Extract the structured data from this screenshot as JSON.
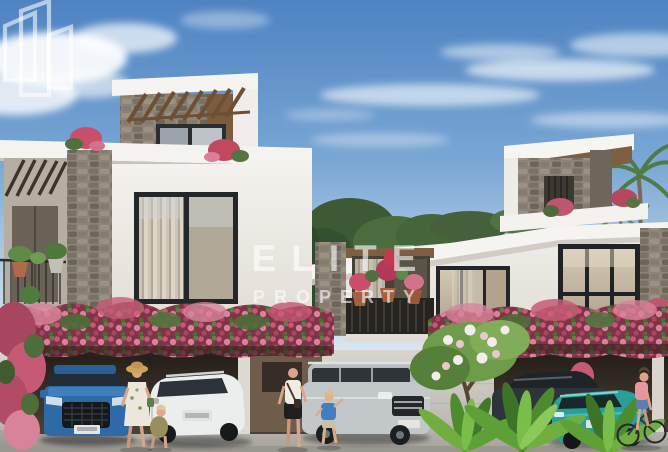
{
  "watermark": {
    "line1": "ELITE",
    "line2": "PROPERTY",
    "logo_icon": "buildings-outline-logo-icon",
    "color": "#FFFFFF",
    "opacity": 0.6
  },
  "scene": {
    "alt": "Rendering of modern two-storey stone and white villas with rooftop pergolas, bougainvillea-covered carports, parked cars, pedestrians and a cyclist on a sunny street",
    "elements": {
      "left_villa": "white villa with stone tower and wood pergola",
      "right_villa": "white villa with rooftop terrace and palm trees",
      "vehicles": [
        "blue suv",
        "white suv",
        "silver suv",
        "dark sedan",
        "teal car"
      ],
      "people": [
        "woman with straw hat",
        "crouching child",
        "woman with shoulder bag",
        "toddler in blue shirt",
        "cyclist in pink top"
      ]
    }
  },
  "palette": {
    "sky_blue": "#4e83c2",
    "sky_horizon": "#d9e4ee",
    "wall_white": "#f2f0ec",
    "stone_gray": "#857c70",
    "wood_brown": "#7b5c3e",
    "bougainvillea_pink": "#c25570",
    "foliage_green": "#4f7d3a",
    "street_gray": "#c9c6c0",
    "car_blue": "#2e6aa8",
    "car_white": "#eceeed",
    "car_silver": "#c2c7ca",
    "car_teal": "#27a09a",
    "car_dark": "#2f343a",
    "watermark_white": "rgba(255,255,255,0.6)"
  }
}
